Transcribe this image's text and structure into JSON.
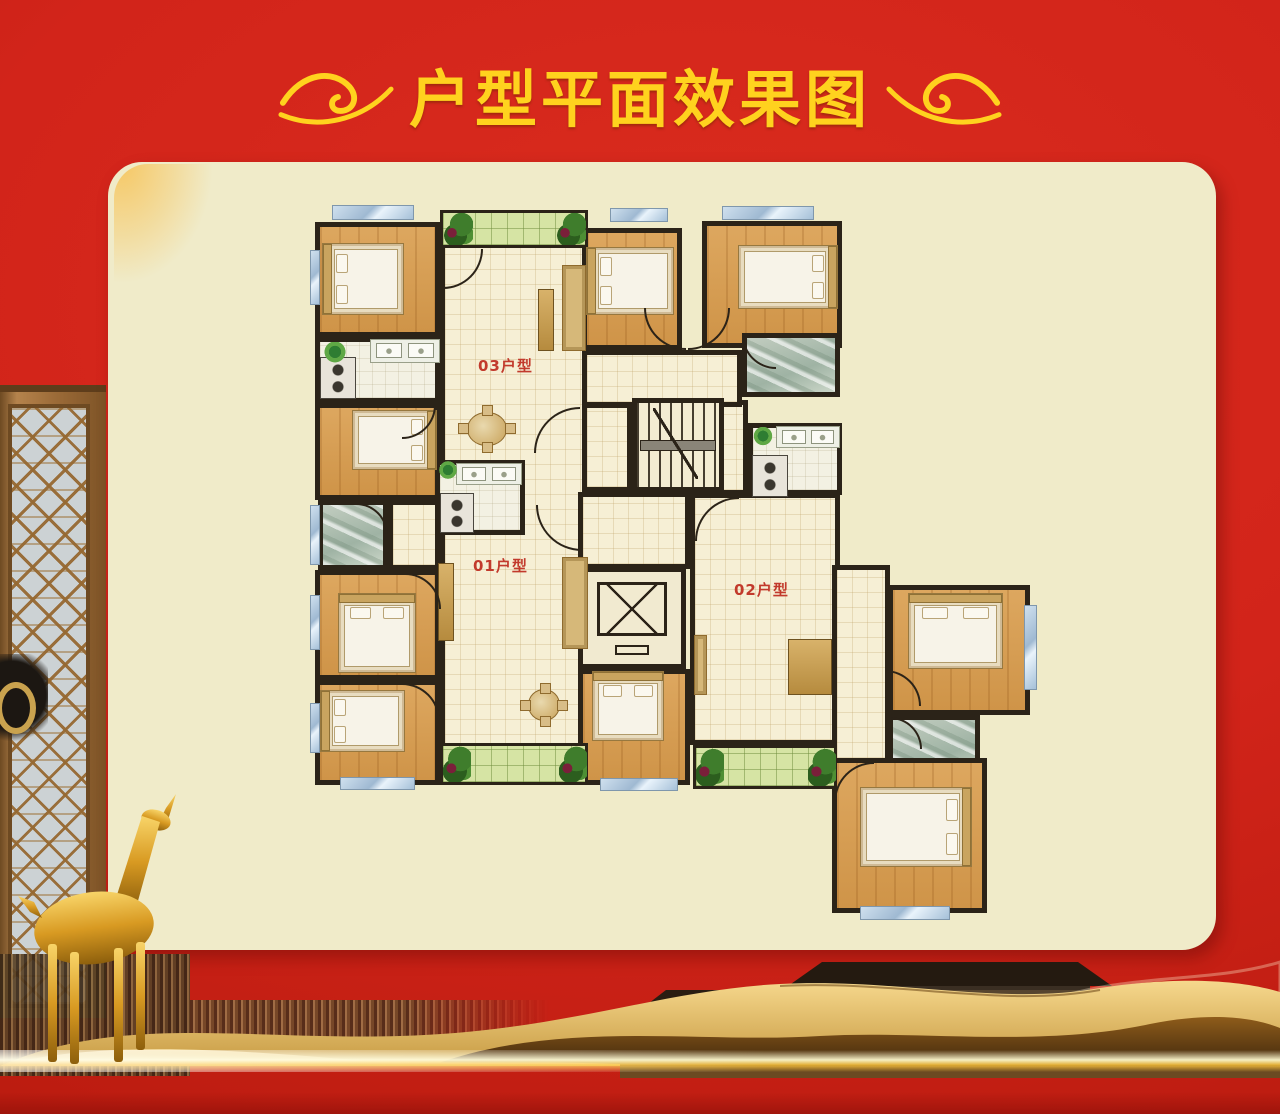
{
  "title": {
    "text": "户型平面效果图"
  },
  "colors": {
    "gold": "#ffd21e",
    "cream": "#f0ebc9",
    "wall": "#2b2318",
    "labelred": "#c23a2c",
    "redbg": "#d2241a"
  },
  "floorplan": {
    "origin": {
      "left": 310,
      "top": 205,
      "width": 725,
      "height": 740
    },
    "rooms": [
      {
        "name": "living-dining-03",
        "type": "tile",
        "x": 130,
        "y": 5,
        "w": 148,
        "h": 575
      },
      {
        "name": "hall",
        "type": "tile",
        "x": 376,
        "y": 195,
        "w": 62,
        "h": 95
      },
      {
        "name": "hall",
        "type": "tile",
        "x": 268,
        "y": 287,
        "w": 112,
        "h": 77
      },
      {
        "name": "corridor",
        "type": "tile",
        "x": 272,
        "y": 145,
        "w": 160,
        "h": 57
      },
      {
        "name": "stair-landing",
        "type": "tile",
        "x": 272,
        "y": 198,
        "w": 50,
        "h": 89
      },
      {
        "name": "living-room-02",
        "type": "tile",
        "x": 380,
        "y": 288,
        "w": 150,
        "h": 252
      },
      {
        "name": "hallway-02",
        "type": "tile",
        "x": 522,
        "y": 360,
        "w": 58,
        "h": 198
      },
      {
        "name": "hallway-01",
        "type": "tile",
        "x": 78,
        "y": 295,
        "w": 52,
        "h": 70
      },
      {
        "name": "bedroom",
        "type": "wood",
        "x": 5,
        "y": 17,
        "w": 125,
        "h": 115
      },
      {
        "name": "kitchen-utility",
        "type": "tileL",
        "x": 5,
        "y": 132,
        "w": 125,
        "h": 66
      },
      {
        "name": "bedroom",
        "type": "wood",
        "x": 5,
        "y": 198,
        "w": 125,
        "h": 97
      },
      {
        "name": "bathroom",
        "type": "marble",
        "x": 8,
        "y": 295,
        "w": 70,
        "h": 70
      },
      {
        "name": "bedroom",
        "type": "wood",
        "x": 5,
        "y": 365,
        "w": 125,
        "h": 110
      },
      {
        "name": "bedroom",
        "type": "wood",
        "x": 5,
        "y": 475,
        "w": 125,
        "h": 105
      },
      {
        "name": "bedroom",
        "type": "wood",
        "x": 272,
        "y": 23,
        "w": 100,
        "h": 122
      },
      {
        "name": "bedroom",
        "type": "wood",
        "x": 392,
        "y": 16,
        "w": 140,
        "h": 127
      },
      {
        "name": "bathroom",
        "type": "marble",
        "x": 432,
        "y": 128,
        "w": 98,
        "h": 64
      },
      {
        "name": "kitchen-02",
        "type": "tileL",
        "x": 438,
        "y": 218,
        "w": 94,
        "h": 72
      },
      {
        "name": "kitchen-01",
        "type": "tileL",
        "x": 125,
        "y": 255,
        "w": 90,
        "h": 75
      },
      {
        "name": "bedroom",
        "type": "wood",
        "x": 578,
        "y": 380,
        "w": 142,
        "h": 130
      },
      {
        "name": "bathroom",
        "type": "marble",
        "x": 578,
        "y": 510,
        "w": 92,
        "h": 70
      },
      {
        "name": "bedroom",
        "type": "wood",
        "x": 522,
        "y": 553,
        "w": 155,
        "h": 155
      },
      {
        "name": "elevator",
        "type": "elev",
        "x": 268,
        "y": 362,
        "w": 108,
        "h": 102
      },
      {
        "name": "bedroom",
        "type": "wood",
        "x": 268,
        "y": 464,
        "w": 112,
        "h": 116
      },
      {
        "name": "stairwell",
        "type": "stairs",
        "x": 322,
        "y": 193,
        "w": 92,
        "h": 94
      },
      {
        "name": "balcony",
        "type": "green",
        "x": 130,
        "y": 5,
        "w": 148,
        "h": 38
      },
      {
        "name": "balcony",
        "type": "green",
        "x": 130,
        "y": 538,
        "w": 148,
        "h": 42
      },
      {
        "name": "balcony",
        "type": "green",
        "x": 383,
        "y": 540,
        "w": 144,
        "h": 44
      }
    ],
    "windows": [
      {
        "x": 22,
        "y": 0,
        "w": 82,
        "h": 15
      },
      {
        "x": 300,
        "y": 3,
        "w": 58,
        "h": 14
      },
      {
        "x": 412,
        "y": 1,
        "w": 92,
        "h": 14
      },
      {
        "x": 0,
        "y": 45,
        "w": 10,
        "h": 55
      },
      {
        "x": 0,
        "y": 300,
        "w": 10,
        "h": 60
      },
      {
        "x": 0,
        "y": 390,
        "w": 10,
        "h": 55
      },
      {
        "x": 0,
        "y": 498,
        "w": 10,
        "h": 50
      },
      {
        "x": 30,
        "y": 572,
        "w": 75,
        "h": 13
      },
      {
        "x": 290,
        "y": 573,
        "w": 78,
        "h": 13
      },
      {
        "x": 714,
        "y": 400,
        "w": 13,
        "h": 85
      },
      {
        "x": 550,
        "y": 701,
        "w": 90,
        "h": 14
      }
    ],
    "doors": [
      {
        "x": 133,
        "y": 44,
        "r": 40,
        "q": "br"
      },
      {
        "x": 224,
        "y": 202,
        "r": 46,
        "q": "tl"
      },
      {
        "x": 226,
        "y": 300,
        "r": 46,
        "q": "bl"
      },
      {
        "x": 334,
        "y": 103,
        "r": 42,
        "q": "bl"
      },
      {
        "x": 378,
        "y": 103,
        "r": 42,
        "q": "br"
      },
      {
        "x": 95,
        "y": 368,
        "r": 36,
        "q": "tr"
      },
      {
        "x": 92,
        "y": 478,
        "r": 38,
        "q": "tr"
      },
      {
        "x": 92,
        "y": 200,
        "r": 34,
        "q": "br"
      },
      {
        "x": 385,
        "y": 292,
        "r": 44,
        "q": "tl"
      },
      {
        "x": 575,
        "y": 465,
        "r": 36,
        "q": "tr"
      },
      {
        "x": 524,
        "y": 557,
        "r": 40,
        "q": "tl"
      },
      {
        "x": 46,
        "y": 298,
        "r": 32,
        "q": "tr"
      },
      {
        "x": 432,
        "y": 130,
        "r": 34,
        "q": "bl"
      },
      {
        "x": 580,
        "y": 512,
        "r": 32,
        "q": "tr"
      }
    ],
    "furniture": [
      {
        "t": "bed",
        "x": 12,
        "y": 38,
        "w": 82,
        "h": 72,
        "dir": "l"
      },
      {
        "t": "bed",
        "x": 42,
        "y": 205,
        "w": 85,
        "h": 60,
        "dir": "r"
      },
      {
        "t": "bed",
        "x": 28,
        "y": 388,
        "w": 78,
        "h": 80,
        "dir": "t"
      },
      {
        "t": "bed",
        "x": 10,
        "y": 485,
        "w": 85,
        "h": 62,
        "dir": "l"
      },
      {
        "t": "bed",
        "x": 276,
        "y": 42,
        "w": 88,
        "h": 68,
        "dir": "l"
      },
      {
        "t": "bed",
        "x": 428,
        "y": 40,
        "w": 100,
        "h": 64,
        "dir": "r"
      },
      {
        "t": "bed",
        "x": 598,
        "y": 388,
        "w": 95,
        "h": 76,
        "dir": "t"
      },
      {
        "t": "bed",
        "x": 550,
        "y": 582,
        "w": 112,
        "h": 80,
        "dir": "r"
      },
      {
        "t": "bed",
        "x": 282,
        "y": 466,
        "w": 72,
        "h": 70,
        "dir": "t"
      },
      {
        "t": "table",
        "x": 148,
        "y": 200,
        "w": 58,
        "h": 48
      },
      {
        "t": "table",
        "x": 210,
        "y": 478,
        "w": 48,
        "h": 44
      },
      {
        "t": "cab",
        "x": 228,
        "y": 84,
        "w": 16,
        "h": 62
      },
      {
        "t": "sofa",
        "x": 252,
        "y": 60,
        "w": 24,
        "h": 86
      },
      {
        "t": "cab",
        "x": 128,
        "y": 358,
        "w": 16,
        "h": 78
      },
      {
        "t": "sofa",
        "x": 252,
        "y": 352,
        "w": 26,
        "h": 92
      },
      {
        "t": "cab",
        "x": 478,
        "y": 434,
        "w": 44,
        "h": 56
      },
      {
        "t": "sofa",
        "x": 384,
        "y": 430,
        "w": 13,
        "h": 60
      },
      {
        "t": "counter",
        "x": 60,
        "y": 134,
        "w": 70,
        "h": 24
      },
      {
        "t": "stove",
        "x": 10,
        "y": 152,
        "w": 36,
        "h": 42
      },
      {
        "t": "counter",
        "x": 146,
        "y": 258,
        "w": 66,
        "h": 22
      },
      {
        "t": "stove",
        "x": 130,
        "y": 288,
        "w": 34,
        "h": 40
      },
      {
        "t": "counter",
        "x": 466,
        "y": 221,
        "w": 64,
        "h": 22
      },
      {
        "t": "stove",
        "x": 442,
        "y": 250,
        "w": 36,
        "h": 42
      },
      {
        "t": "plant",
        "x": 12,
        "y": 137,
        "w": 26,
        "h": 22
      },
      {
        "t": "plant",
        "x": 128,
        "y": 256,
        "w": 20,
        "h": 20
      },
      {
        "t": "plant",
        "x": 442,
        "y": 222,
        "w": 22,
        "h": 20
      },
      {
        "t": "shrub",
        "x": 133,
        "y": 8,
        "w": 30,
        "h": 32
      },
      {
        "t": "shrub",
        "x": 246,
        "y": 8,
        "w": 30,
        "h": 32
      },
      {
        "t": "shrub",
        "x": 133,
        "y": 541,
        "w": 28,
        "h": 36
      },
      {
        "t": "shrub",
        "x": 249,
        "y": 541,
        "w": 28,
        "h": 36
      },
      {
        "t": "shrub",
        "x": 386,
        "y": 543,
        "w": 28,
        "h": 38
      },
      {
        "t": "shrub",
        "x": 498,
        "y": 543,
        "w": 28,
        "h": 38
      }
    ],
    "labels": [
      {
        "text": "03户型",
        "x": 168,
        "y": 150
      },
      {
        "text": "01户型",
        "x": 163,
        "y": 350
      },
      {
        "text": "02户型",
        "x": 424,
        "y": 374
      }
    ]
  }
}
